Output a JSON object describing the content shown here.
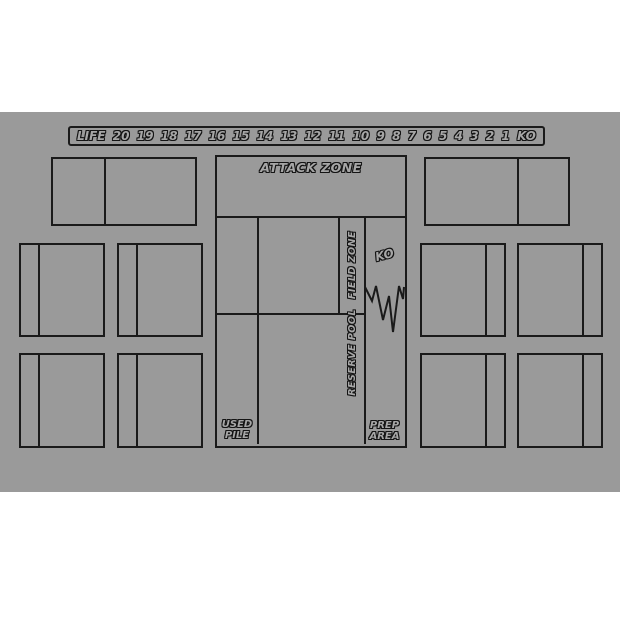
{
  "colors": {
    "page_bg": "#ffffff",
    "mat_bg": "#9a9a9a",
    "line": "#1a1a1a",
    "letter_fill": "#a6a6a6",
    "letter_outline": "#141414"
  },
  "life_track": {
    "label": "LIFE",
    "values": [
      "20",
      "19",
      "18",
      "17",
      "16",
      "15",
      "14",
      "13",
      "12",
      "11",
      "10",
      "9",
      "8",
      "7",
      "6",
      "5",
      "4",
      "3",
      "2",
      "1",
      "KO"
    ]
  },
  "zones": {
    "attack": "ATTACK ZONE",
    "field": "FIELD ZONE",
    "reserve": "RESERVE POOL",
    "ko": "KO",
    "used_line1": "USED",
    "used_line2": "PILE",
    "prep_line1": "PREP",
    "prep_line2": "AREA"
  },
  "card_slots": {
    "top_pairs": 2,
    "left_grid_cards": 4,
    "right_grid_cards": 4
  }
}
